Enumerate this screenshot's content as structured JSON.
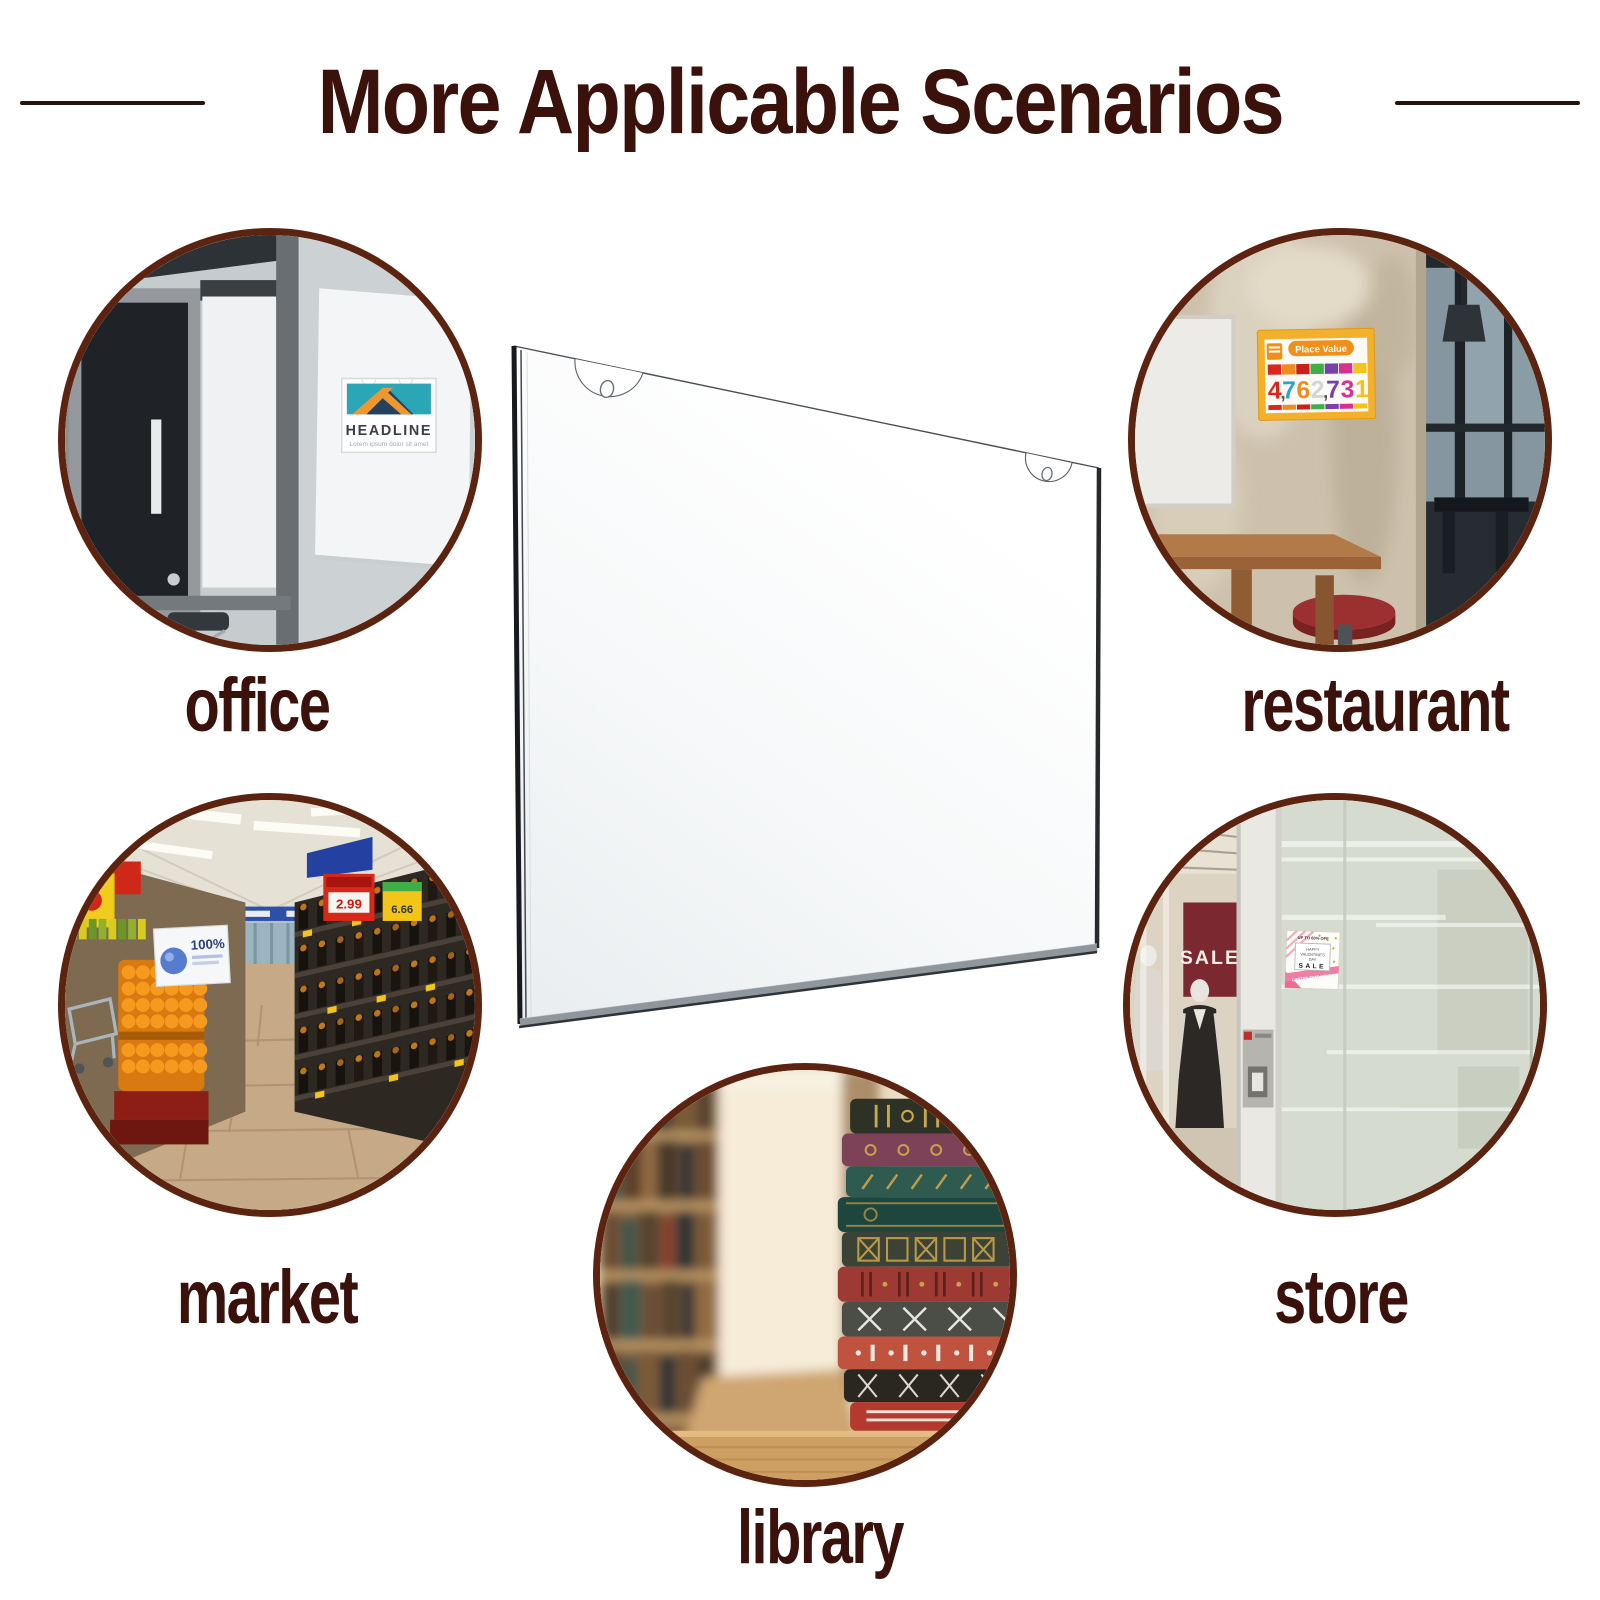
{
  "title": {
    "text": "More Applicable Scenarios"
  },
  "scenarios": {
    "office": {
      "label": "office",
      "poster": {
        "headline": "HEADLINE",
        "subtext": "Lorem ipsum dolor sit amet"
      }
    },
    "restaurant": {
      "label": "restaurant",
      "poster": {
        "title": "Place Value",
        "number": "4,762,731",
        "digits": [
          {
            "ch": "4",
            "color": "#d8281e"
          },
          {
            "ch": ",",
            "color": "#5a5550"
          },
          {
            "ch": "7",
            "color": "#2fa3c4"
          },
          {
            "ch": "6",
            "color": "#ef8c1e"
          },
          {
            "ch": "2",
            "color": "#d3d6d8"
          },
          {
            "ch": ",",
            "color": "#5a5550"
          },
          {
            "ch": "7",
            "color": "#7a3fa8"
          },
          {
            "ch": "3",
            "color": "#d8308e"
          },
          {
            "ch": "1",
            "color": "#f2c51e"
          }
        ]
      }
    },
    "market": {
      "label": "market",
      "signs": {
        "red_price": "2.99",
        "yellow_price": "6.66",
        "banner": "100%"
      }
    },
    "store": {
      "label": "store",
      "window_banner": "SALE",
      "poster": {
        "top": "UP TO 60% OFF",
        "line1": "HAPPY",
        "line2": "VALENTINE'S",
        "line3": "DAY",
        "sale": "SALE",
        "bottom": "LIMITED TIME ONLY"
      }
    },
    "library": {
      "label": "library"
    }
  },
  "colors": {
    "heading": "#3a110b",
    "circle_border": "#5c2410",
    "poster_teal": "#2ba6b6",
    "poster_orange": "#f0962e",
    "place_value_yellow": "#f2b02c",
    "sale_maroon": "#7c2830",
    "valentine_pink": "#ee6a92"
  }
}
